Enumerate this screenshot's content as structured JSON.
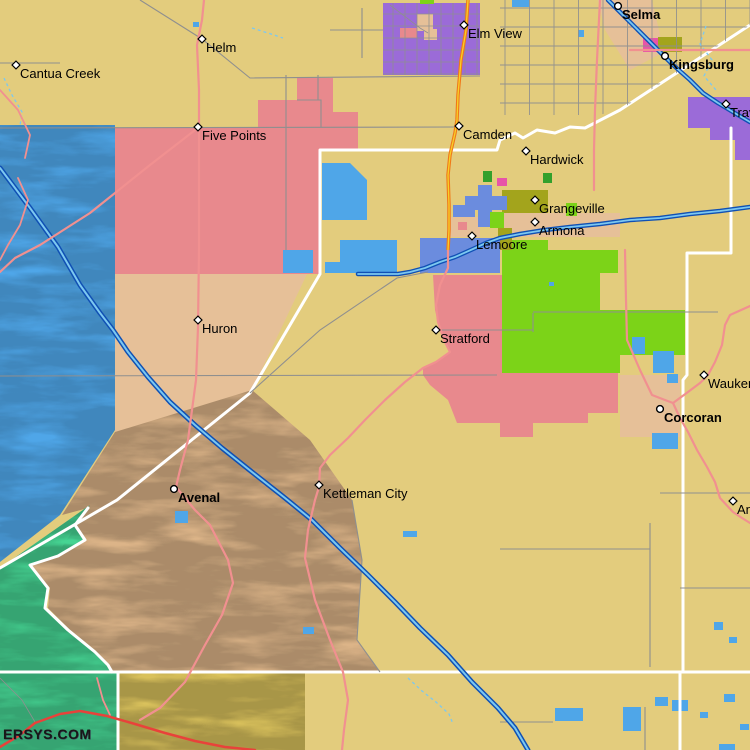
{
  "map": {
    "watermark": "ERSYS.COM",
    "label_offset": {
      "dx": 4,
      "dy": 13
    },
    "towns": [
      {
        "name": "Cantua Creek",
        "x": 16,
        "y": 65,
        "marker": "diamond",
        "bold": false
      },
      {
        "name": "Helm",
        "x": 202,
        "y": 39,
        "marker": "diamond",
        "bold": false
      },
      {
        "name": "Five Points",
        "x": 198,
        "y": 127,
        "marker": "diamond",
        "bold": false
      },
      {
        "name": "Elm View",
        "x": 464,
        "y": 25,
        "marker": "diamond",
        "bold": false
      },
      {
        "name": "Camden",
        "x": 459,
        "y": 126,
        "marker": "diamond",
        "bold": false
      },
      {
        "name": "Selma",
        "x": 618,
        "y": 6,
        "marker": "circle",
        "bold": true
      },
      {
        "name": "Kingsburg",
        "x": 665,
        "y": 56,
        "marker": "circle",
        "bold": true
      },
      {
        "name": "Traver",
        "x": 726,
        "y": 104,
        "marker": "diamond",
        "bold": false
      },
      {
        "name": "Hardwick",
        "x": 526,
        "y": 151,
        "marker": "diamond",
        "bold": false
      },
      {
        "name": "Grangeville",
        "x": 535,
        "y": 200,
        "marker": "diamond",
        "bold": false
      },
      {
        "name": "Armona",
        "x": 535,
        "y": 222,
        "marker": "diamond",
        "bold": false
      },
      {
        "name": "Lemoore",
        "x": 472,
        "y": 236,
        "marker": "diamond",
        "bold": false
      },
      {
        "name": "Huron",
        "x": 198,
        "y": 320,
        "marker": "diamond",
        "bold": false
      },
      {
        "name": "Stratford",
        "x": 436,
        "y": 330,
        "marker": "diamond",
        "bold": false
      },
      {
        "name": "Waukena",
        "x": 704,
        "y": 375,
        "marker": "diamond",
        "bold": false
      },
      {
        "name": "Corcoran",
        "x": 660,
        "y": 409,
        "marker": "circle",
        "bold": true
      },
      {
        "name": "Avenal",
        "x": 174,
        "y": 489,
        "marker": "circle",
        "bold": true
      },
      {
        "name": "Kettleman City",
        "x": 319,
        "y": 485,
        "marker": "diamond",
        "bold": false
      },
      {
        "name": "Angiola",
        "x": 733,
        "y": 501,
        "marker": "diamond",
        "bold": false
      }
    ],
    "colors": {
      "land": "#E3CC7D",
      "region_pink": "#E8898D",
      "water_blue": "#4FA6E8",
      "canal_dark": "#1050B4",
      "canal_light": "#7CC8F0",
      "purple": "#9B6BD8",
      "chartreuse": "#7CD318",
      "olive": "#A3A41C",
      "spring_green": "#46D493",
      "peach": "#E6C098",
      "cornflower": "#6B8CDE",
      "magenta": "#E754A8",
      "dark_green": "#33A02C",
      "highway_salmon": "#F19090",
      "highway_red": "#E8423A",
      "highway_orange": "#F07818",
      "highway_yellow": "#F8D028",
      "road_gray": "#8F8F8F",
      "county_line": "#FFFFFF",
      "hills_tan": "#DCB488",
      "hills_yellow": "#D9C15C",
      "label_color": "#000000"
    }
  }
}
